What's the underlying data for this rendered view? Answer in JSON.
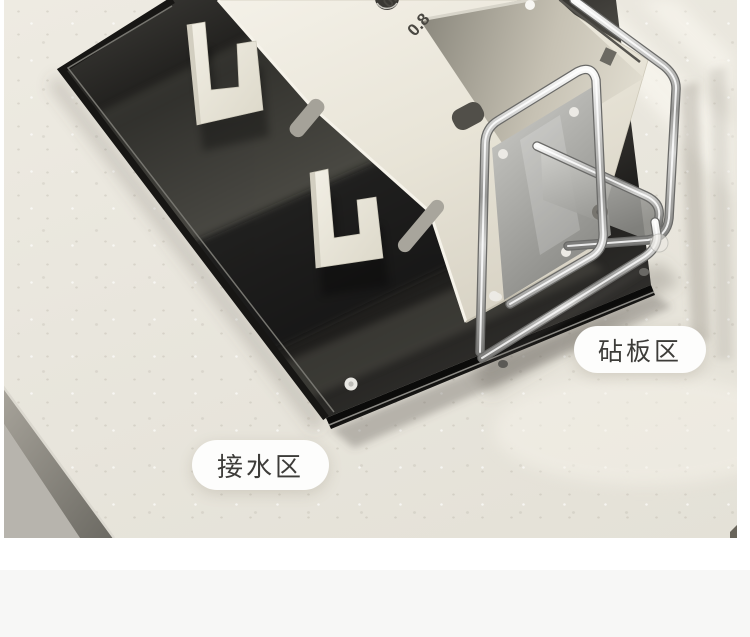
{
  "page": {
    "section_divider_color": "#ffffff",
    "next_section_color": "#f7f7f6"
  },
  "product_photo": {
    "zone_labels": {
      "cutting_board_zone": "砧板区",
      "water_catch_zone": "接水区"
    },
    "scale_markings": {
      "mark_small": "0.5",
      "mark_large": "0.8"
    },
    "palette": {
      "countertop": "#e9e6dd",
      "drip_tray": "#1c1b19",
      "knife_block": "#ece8db",
      "chrome_rack": "#b9b9b7",
      "label_background": "#fdfdfc",
      "label_text": "#3d3c39"
    }
  }
}
